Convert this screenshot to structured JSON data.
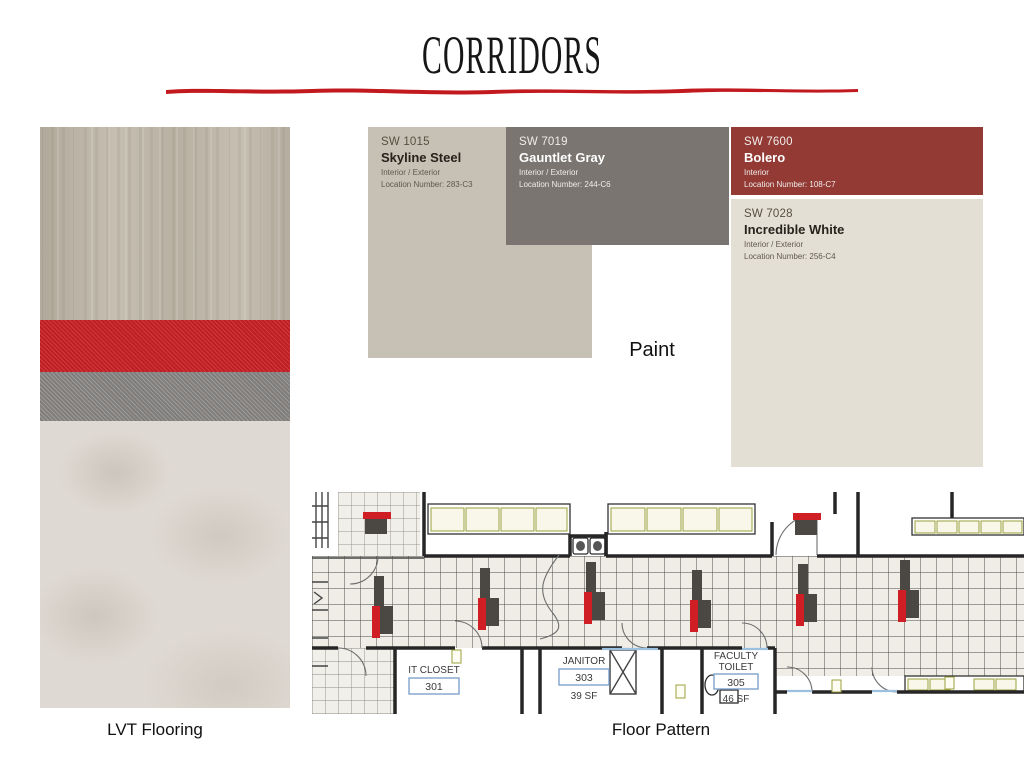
{
  "page": {
    "title": "CORRIDORS",
    "background": "#ffffff"
  },
  "theme": {
    "underline_red": "#c2191e",
    "accent_red": "#cf1f24",
    "accent_charcoal": "#4b4843",
    "plan_tile_fill": "#efede6",
    "blue_threshold": "#9dc0e0",
    "casework_green": "#9aa03a"
  },
  "labels": {
    "paint": "Paint",
    "lvt_flooring": "LVT Flooring",
    "floor_pattern": "Floor Pattern"
  },
  "flooring": {
    "sections": {
      "wood": "#c6bfb1",
      "red_stripe": "#cb2127",
      "gray_stripe": "#8d8a88",
      "stone": "#ded9d2"
    }
  },
  "paint": {
    "chips": [
      {
        "code": "SW 1015",
        "name": "Skyline Steel",
        "usage": "Interior / Exterior",
        "location": "Location Number: 283-C3",
        "color": "#c7c0b4",
        "tone": "dark"
      },
      {
        "code": "SW 7019",
        "name": "Gauntlet Gray",
        "usage": "Interior / Exterior",
        "location": "Location Number: 244-C6",
        "color": "#7a7570",
        "tone": "light"
      },
      {
        "code": "SW 7600",
        "name": "Bolero",
        "usage": "Interior",
        "location": "Location Number: 108-C7",
        "color": "#943a34",
        "tone": "light"
      },
      {
        "code": "SW 7028",
        "name": "Incredible White",
        "usage": "Interior / Exterior",
        "location": "Location Number: 256-C4",
        "color": "#e3dfd5",
        "tone": "dark"
      }
    ]
  },
  "plan": {
    "rooms": [
      {
        "name": "IT CLOSET",
        "number": "301",
        "area": ""
      },
      {
        "name": "JANITOR",
        "number": "303",
        "area": "39 SF"
      },
      {
        "name_line1": "FACULTY",
        "name_line2": "TOILET",
        "number": "305",
        "area": "46 SF"
      }
    ]
  }
}
